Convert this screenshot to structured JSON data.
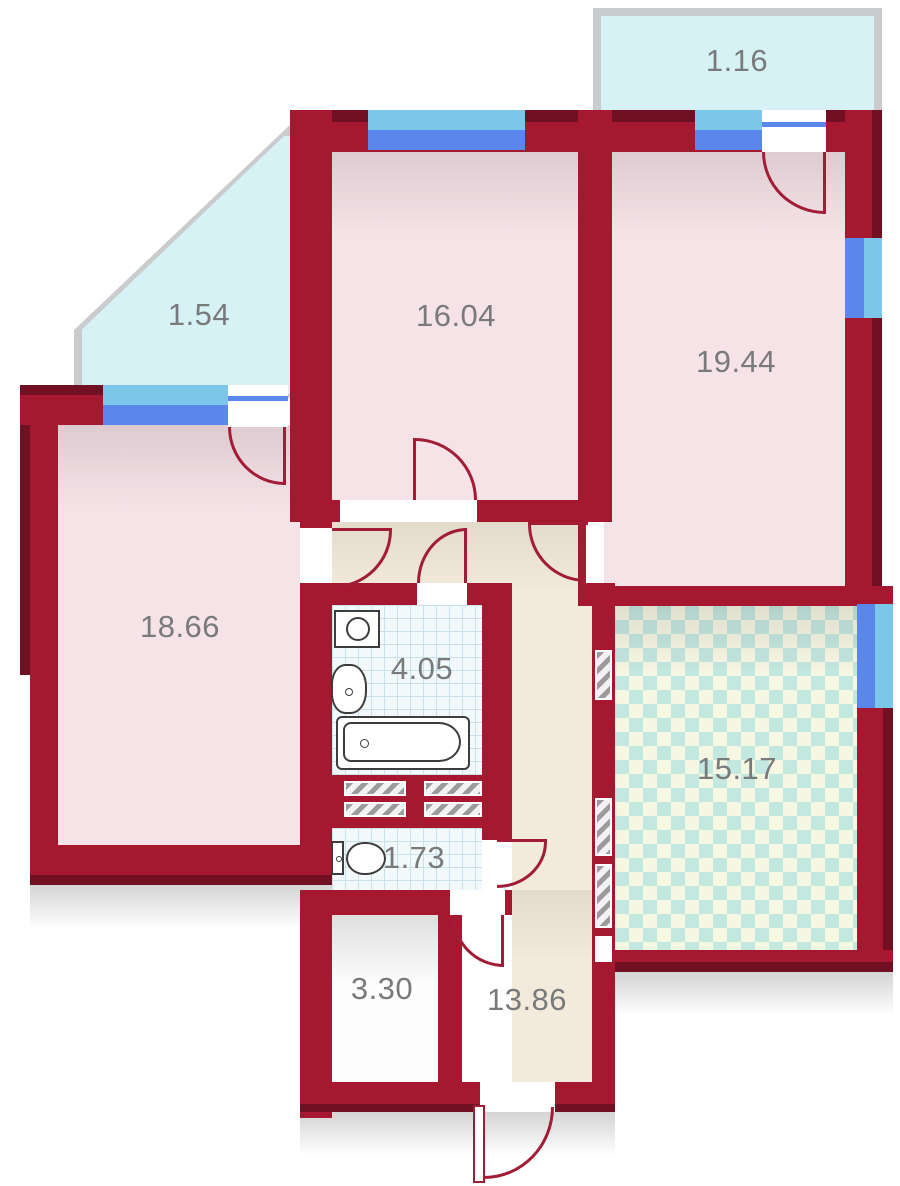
{
  "plan": {
    "title": "apartment-floor-plan",
    "rooms": {
      "balcony_top": {
        "area": "1.16"
      },
      "balcony_left": {
        "area": "1.54"
      },
      "bedroom_top": {
        "area": "16.04"
      },
      "bedroom_right": {
        "area": "19.44"
      },
      "living_left": {
        "area": "18.66"
      },
      "bathroom": {
        "area": "4.05"
      },
      "kitchen": {
        "area": "15.17"
      },
      "wc": {
        "area": "1.73"
      },
      "storage": {
        "area": "3.30"
      },
      "hallway": {
        "area": "13.86"
      }
    },
    "colors": {
      "wall": "#A6182F",
      "wall-dark": "#701022",
      "room-fill": "#F5E3E8",
      "hall-fill": "#F2EADB",
      "balcony-fill": "#D6F2F4",
      "balcony-border": "#C9CBCD",
      "window-light": "#7CC7E9",
      "window-blue": "#5A87E9",
      "tile-bg": "#F2F9FB",
      "tile-line": "#CBE1EA",
      "checker-teal": "#C2E8E0",
      "checker-cream": "#F6F7E3",
      "door-arc": "#A21C36",
      "label": "#797A7C"
    }
  }
}
